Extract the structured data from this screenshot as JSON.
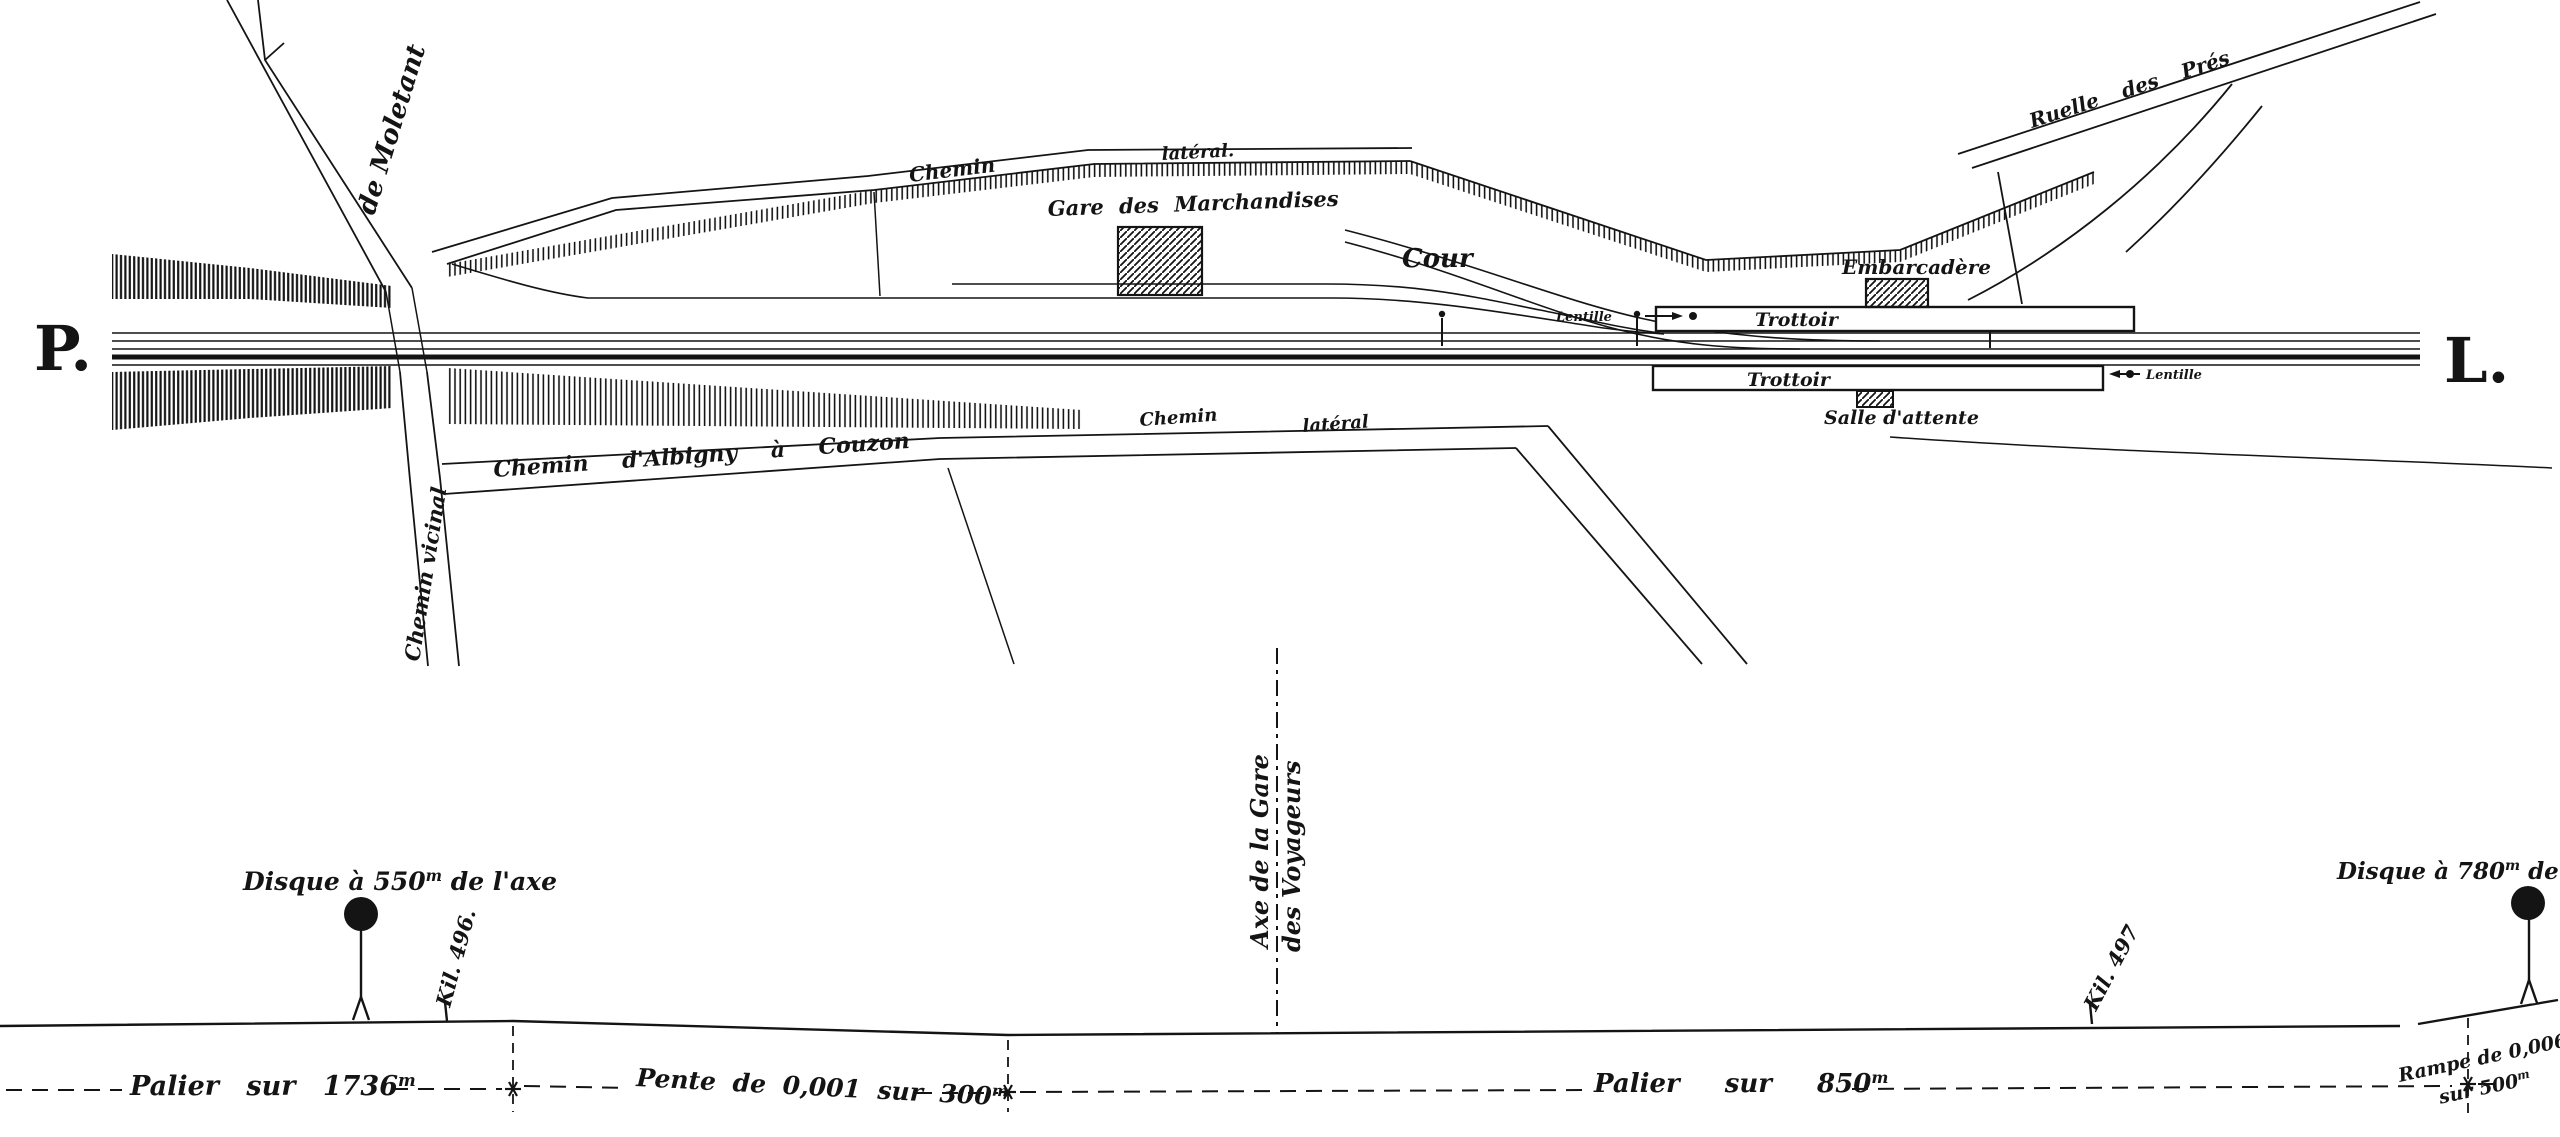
{
  "colors": {
    "ink": "#141414",
    "paper": "#ffffff"
  },
  "plan": {
    "endpoint_left": "P.",
    "endpoint_right": "L.",
    "roads": {
      "de_moletant": "de Moletant",
      "chemin_vicinal": "Chemin vicinal",
      "chemin_top_1": "Chemin",
      "chemin_top_2": "latéral.",
      "albigny": "Chemin d'Albigny à Couzon",
      "chemin_bottom_1": "Chemin",
      "chemin_bottom_2": "latéral",
      "ruelle": "Ruelle des Prés"
    },
    "station": {
      "goods": "Gare des Marchandises",
      "cour": "Cour",
      "embarcadere": "Embarcadère",
      "trottoir_upper": "Trottoir",
      "trottoir_lower": "Trottoir",
      "salle": "Salle d'attente",
      "lentille_left": "Lentille",
      "lentille_right": "Lentille"
    }
  },
  "profile": {
    "unit_m": "m",
    "disque_left_pre": "Disque à 550",
    "disque_left_post": " de l'axe",
    "disque_right_pre": "Disque à 780",
    "disque_right_post": " de l'axe",
    "kil_left": "Kil. 496.",
    "kil_right": "Kil. 497",
    "axe_line1": "Axe de la Gare",
    "axe_line2": "des Voyageurs",
    "grades": {
      "palier1_pre": "Palier sur 1736",
      "pente_pre": "Pente de 0,001 sur 300",
      "palier2_pre": "Palier sur 850",
      "rampe_line1": "Rampe de 0,006",
      "rampe_line2_pre": "sur 500"
    }
  }
}
